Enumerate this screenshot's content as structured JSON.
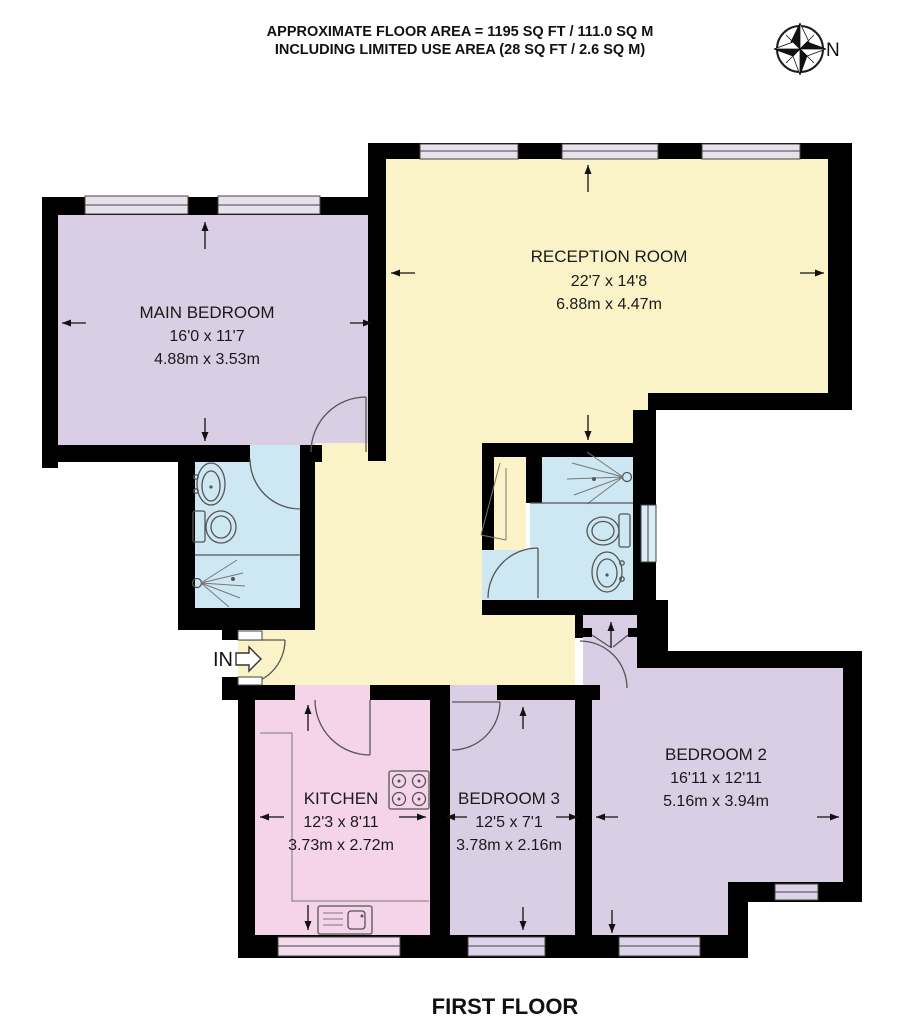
{
  "header": {
    "line1": "APPROXIMATE FLOOR AREA = 1195 SQ FT / 111.0 SQ M",
    "line2": "INCLUDING LIMITED USE AREA (28 SQ FT / 2.6 SQ M)"
  },
  "compass": {
    "label": "N"
  },
  "entrance": {
    "label": "IN"
  },
  "footer": {
    "title": "FIRST FLOOR"
  },
  "rooms": [
    {
      "id": "main-bedroom",
      "name": "MAIN BEDROOM",
      "size_ft": "16'0 x 11'7",
      "size_m": "4.88m x 3.53m",
      "color": "#d9cee4"
    },
    {
      "id": "reception-room",
      "name": "RECEPTION ROOM",
      "size_ft": "22'7 x 14'8",
      "size_m": "6.88m x 4.47m",
      "color": "#faf3c8"
    },
    {
      "id": "kitchen",
      "name": "KITCHEN",
      "size_ft": "12'3 x 8'11",
      "size_m": "3.73m x 2.72m",
      "color": "#f5d4e9"
    },
    {
      "id": "bedroom-3",
      "name": "BEDROOM 3",
      "size_ft": "12'5 x 7'1",
      "size_m": "3.78m x 2.16m",
      "color": "#d9cee4"
    },
    {
      "id": "bedroom-2",
      "name": "BEDROOM 2",
      "size_ft": "16'11 x 12'11",
      "size_m": "5.16m x 3.94m",
      "color": "#d9cee4"
    }
  ],
  "palette": {
    "wall": "#000000",
    "hall_yellow": "#faf3c8",
    "bath_blue": "#cde8f2",
    "lavender": "#d9cee4",
    "pink": "#f5d4e9",
    "window_top": "#e7e1ec",
    "window_blue": "#d9edf6",
    "window_pink": "#f3dcec",
    "window_lav": "#ded4e9",
    "outline": "#555555"
  }
}
